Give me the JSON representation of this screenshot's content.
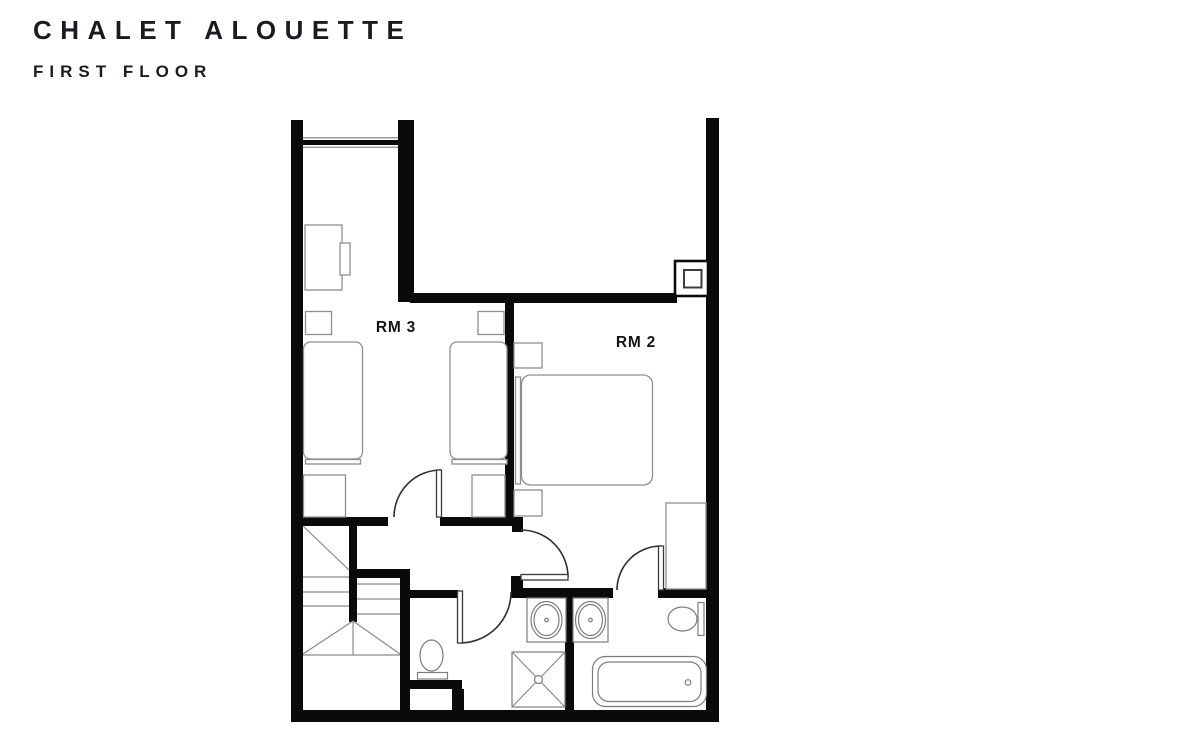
{
  "header": {
    "title": "CHALET ALOUETTE",
    "subtitle": "FIRST FLOOR"
  },
  "floor_plan": {
    "rooms": [
      {
        "id": "rm3",
        "label": "RM 3"
      },
      {
        "id": "rm2",
        "label": "RM 2"
      }
    ],
    "fixtures": [
      "window",
      "chimney-flue",
      "switchback-stairs",
      "desk",
      "desk-chair",
      "twin-bed",
      "twin-bed",
      "double-bed",
      "nightstand",
      "wardrobe",
      "toilet",
      "toilet",
      "sink",
      "sink",
      "shower",
      "bathtub",
      "door-swing"
    ],
    "colors": {
      "wall": "#0a0a0a",
      "fixture_line": "#8f8f8f",
      "door_line": "#2e2e2e",
      "stair_line": "#8a8a8a",
      "label": "#141414",
      "title": "#181b20",
      "background": "#ffffff"
    }
  }
}
